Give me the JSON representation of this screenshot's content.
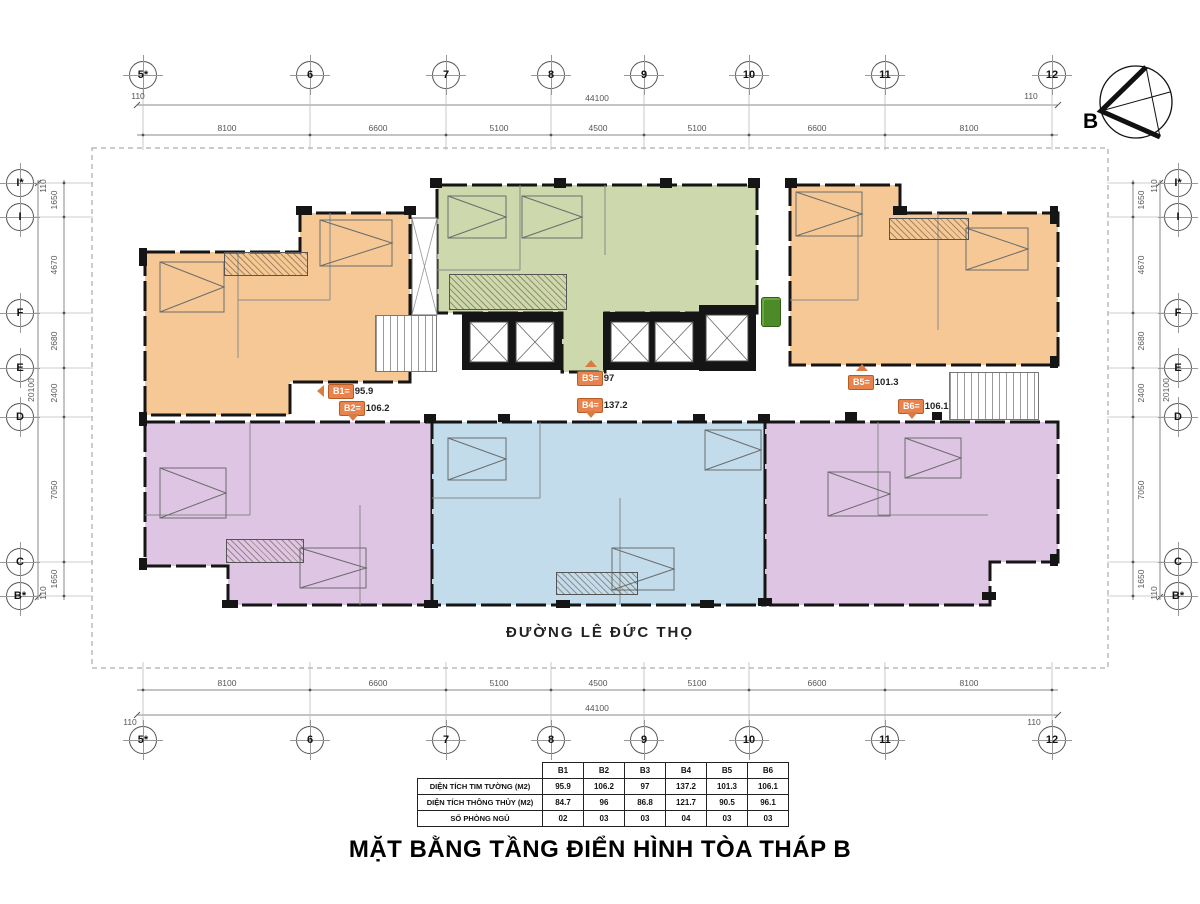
{
  "title": "MẶT BẰNG TẦNG  ĐIỂN HÌNH TÒA THÁP B",
  "street": "ĐƯỜNG LÊ ĐỨC THỌ",
  "compass": {
    "label": "B"
  },
  "grid": {
    "cols": [
      "5*",
      "6",
      "7",
      "8",
      "9",
      "10",
      "11",
      "12"
    ],
    "rows": [
      "I*",
      "I",
      "F",
      "E",
      "D",
      "C",
      "B*"
    ],
    "col_dims": [
      "8100",
      "6600",
      "5100",
      "4500",
      "5100",
      "6600",
      "8100"
    ],
    "row_dims": [
      "1650",
      "4670",
      "2680",
      "2400",
      "7050",
      "1650"
    ],
    "overall_w": "44100",
    "overall_h": "20100",
    "edge": "110"
  },
  "units": [
    {
      "id": "b1",
      "label": "B1=",
      "value": "95.9",
      "arrow": "left"
    },
    {
      "id": "b2",
      "label": "B2=",
      "value": "106.2",
      "arrow": "down"
    },
    {
      "id": "b3",
      "label": "B3=",
      "value": "97",
      "arrow": "up"
    },
    {
      "id": "b4",
      "label": "B4=",
      "value": "137.2",
      "arrow": "down"
    },
    {
      "id": "b5",
      "label": "B5=",
      "value": "101.3",
      "arrow": "up"
    },
    {
      "id": "b6",
      "label": "B6=",
      "value": "106.1",
      "arrow": "down"
    }
  ],
  "table": {
    "columns": [
      "B1",
      "B2",
      "B3",
      "B4",
      "B5",
      "B6"
    ],
    "rows": [
      {
        "label": "DIỆN TÍCH TIM TƯỜNG (M2)",
        "values": [
          "95.9",
          "106.2",
          "97",
          "137.2",
          "101.3",
          "106.1"
        ]
      },
      {
        "label": "DIỆN TÍCH THÔNG THỦY (M2)",
        "values": [
          "84.7",
          "96",
          "86.8",
          "121.7",
          "90.5",
          "96.1"
        ]
      },
      {
        "label": "SỐ PHÒNG NGỦ",
        "values": [
          "02",
          "03",
          "03",
          "04",
          "03",
          "03"
        ]
      }
    ]
  },
  "colors": {
    "orange": "#F5C895",
    "green": "#CDD8AC",
    "purple": "#DFC5E4",
    "blue": "#C2DCEB",
    "tag": "#E8834D",
    "wall": "#151515"
  }
}
